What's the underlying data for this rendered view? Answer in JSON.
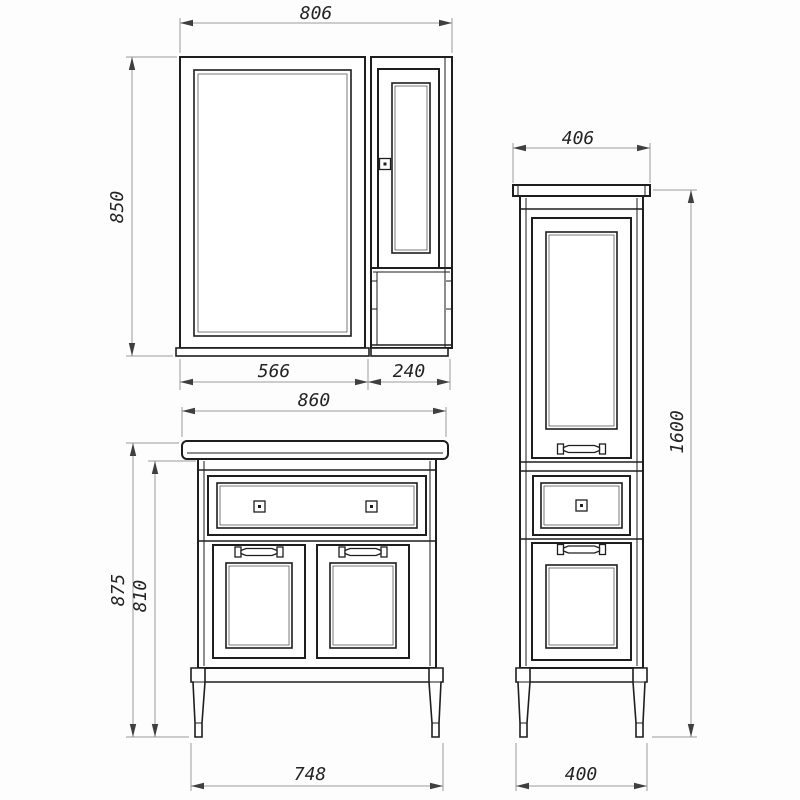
{
  "drawing": {
    "kind": "furniture technical drawing (bathroom set: mirror cabinet, vanity, tall cabinet)",
    "colors": {
      "background": "#fdfdfd",
      "object_line": "#1e1e1e",
      "dimension_line": "#9a9a9a",
      "arrow": "#3f3f3f",
      "text": "#242424"
    }
  },
  "dims": {
    "mirror": {
      "width_total": "806",
      "height": "850",
      "mirror_section_width": "566",
      "side_section_width": "240"
    },
    "vanity": {
      "width_top": "860",
      "height_total": "875",
      "height_body": "810",
      "width_base": "748"
    },
    "tall": {
      "width_top": "406",
      "height": "1600",
      "width_base": "400"
    }
  }
}
